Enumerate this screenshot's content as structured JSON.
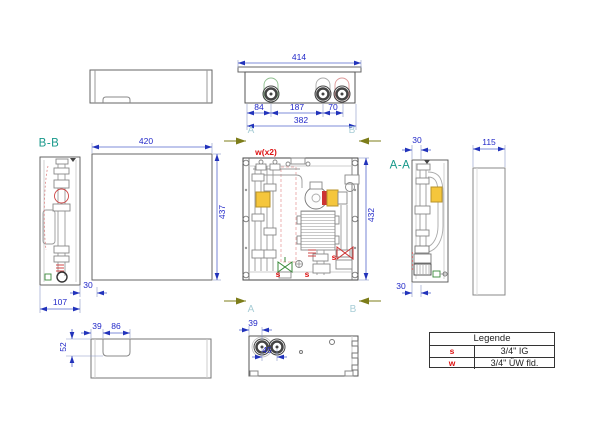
{
  "drawing": {
    "section_labels": {
      "bb": "B-B",
      "aa": "A-A"
    },
    "cut_letters": {
      "a": "A",
      "b": "B"
    },
    "port_labels": {
      "w_note": "w(x2)",
      "s": "s"
    },
    "dimensions": {
      "top_overall": "414",
      "top_left": "84",
      "top_mid": "187",
      "top_right": "70",
      "top_span": "382",
      "front_width": "420",
      "front_height": "437",
      "bb_back": "30",
      "bb_depth": "107",
      "center_height": "432",
      "aa_top": "30",
      "aa_bottom": "30",
      "side_depth": "115",
      "cover_offset": "39",
      "cover_notch": "86",
      "cover_depth": "52",
      "base_offset": "39",
      "base_pitch": "45"
    },
    "legend": {
      "title": "Legende",
      "rows": [
        {
          "key": "s",
          "value": "3/4\" IG"
        },
        {
          "key": "w",
          "value": "3/4\" ÜW fld."
        }
      ]
    },
    "colors": {
      "dimension": "#2228c8",
      "section_label": "#17988a",
      "cut_arrow": "#7d7d1a",
      "marker_red": "#dd1111",
      "valve_yellow": "#f5c63c",
      "valve_green": "#3a8a3a",
      "valve_red": "#cc3333"
    }
  }
}
